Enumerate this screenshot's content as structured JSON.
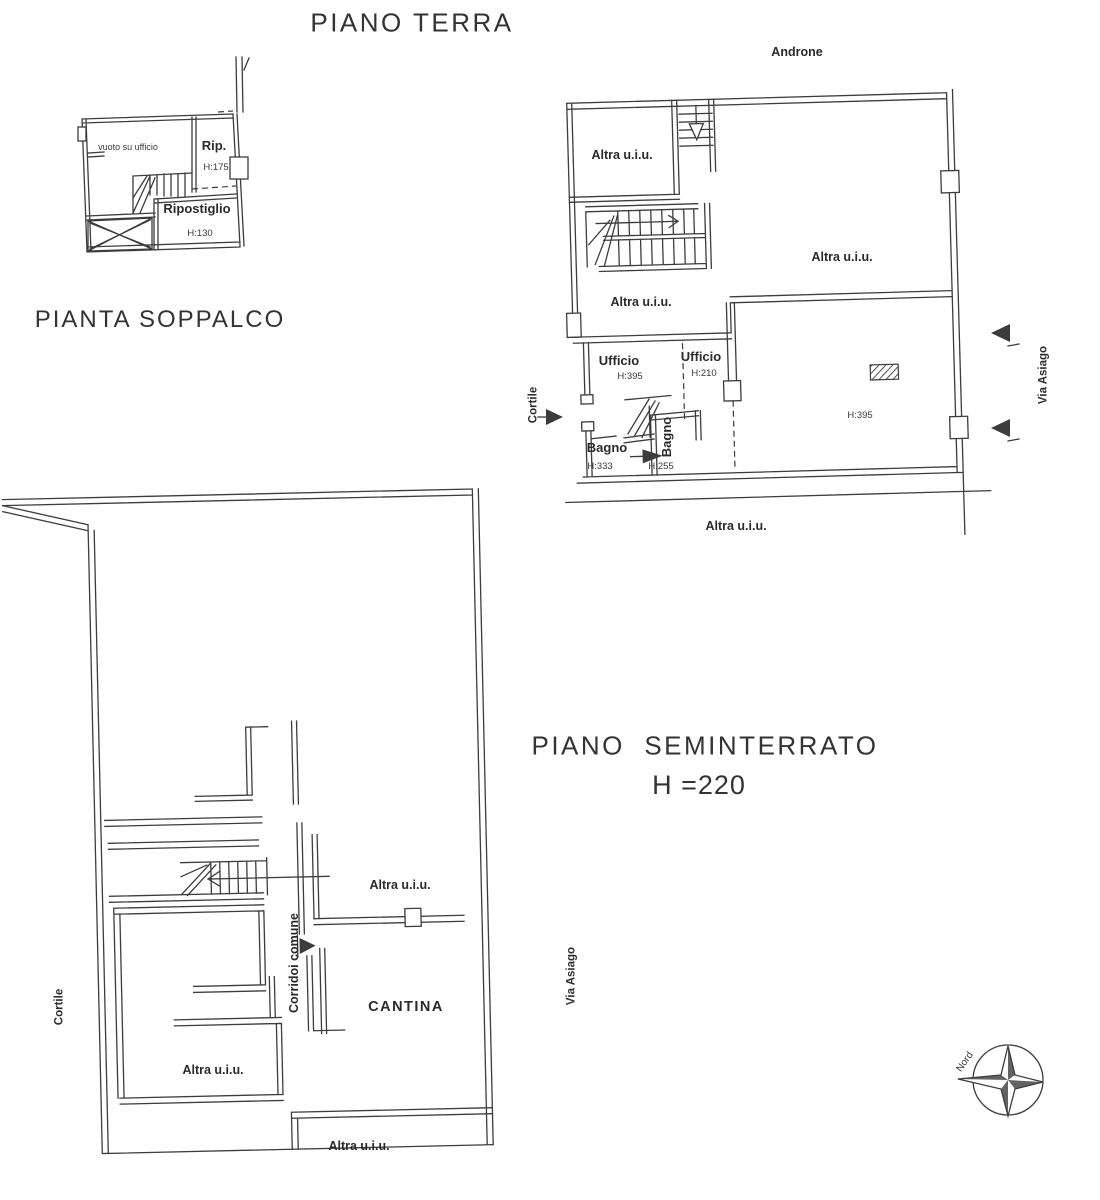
{
  "document": {
    "titles": {
      "piano_terra": "PIANO TERRA",
      "pianta_soppalco": "PIANTA SOPPALCO",
      "piano_seminterrato": "PIANO  SEMINTERRATO",
      "seminterrato_height": "H =220"
    },
    "soppalco": {
      "vuoto": "vuoto su ufficio",
      "rip": "Rip.",
      "rip_h": "H:175",
      "ripostiglio": "Ripostiglio",
      "ripostiglio_h": "H:130"
    },
    "terra": {
      "androne": "Androne",
      "altra_top_left": "Altra u.i.u.",
      "altra_right": "Altra u.i.u.",
      "altra_mid": "Altra u.i.u.",
      "altra_bottom": "Altra u.i.u.",
      "ufficio1": "Ufficio",
      "ufficio1_h": "H:395",
      "ufficio2": "Ufficio",
      "ufficio2_h": "H:210",
      "bagno1": "Bagno",
      "bagno1_h": "H:333",
      "bagno2": "Bagno",
      "bagno2_h": "H:255",
      "sala_h": "H:395",
      "cortile": "Cortile",
      "via_asiago": "Via Asiago"
    },
    "seminterrato": {
      "altra_top": "Altra u.i.u.",
      "corridoi": "Corridoi comune",
      "cantina": "CANTINA",
      "altra_left": "Altra u.i.u.",
      "altra_bottom": "Altra u.i.u.",
      "cortile": "Cortile",
      "via_asiago": "Via Asiago"
    },
    "compass": {
      "north": "Nord"
    },
    "ink_color": "#3c3c3c",
    "paper_color": "#ffffff"
  }
}
